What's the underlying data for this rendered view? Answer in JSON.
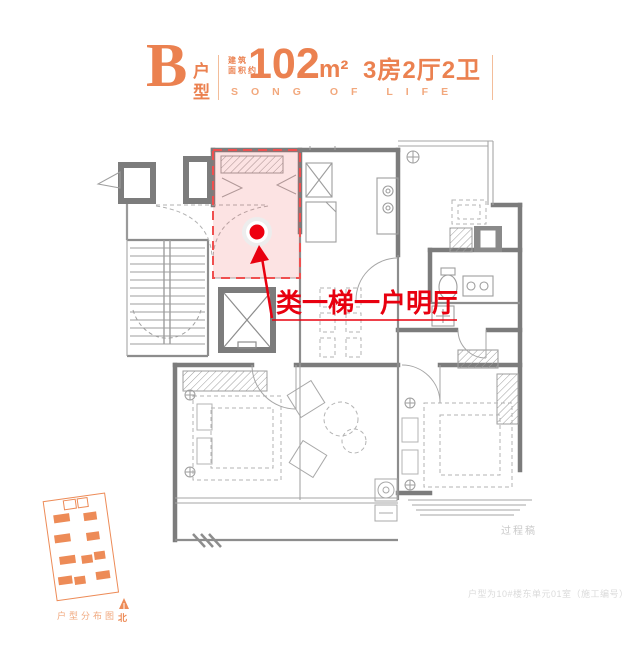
{
  "header": {
    "unit_letter": "B",
    "unit_type_label": "户型",
    "area_prefix_line1": "建筑",
    "area_prefix_line2": "面积约",
    "area_value": "102",
    "area_unit": "m²",
    "rooms_summary": "3房2厅2卫",
    "subtitle": "SONG OF LIFE"
  },
  "annotation": {
    "callout_text": "类一梯一户明厅"
  },
  "plan": {
    "watermark": "过程稿",
    "footnote": "户型为10#楼东单元01室（施工编号）"
  },
  "site_plan": {
    "caption": "户型分布图",
    "north_label": "北"
  },
  "colors": {
    "accent_orange": "#EB8150",
    "subtitle_orange": "#F2A87D",
    "callout_red": "#E8000F",
    "highlight_pink": "#F9DEDD",
    "wall_gray": "#7C7C7C",
    "watermark_gray": "#C9C9C9"
  }
}
